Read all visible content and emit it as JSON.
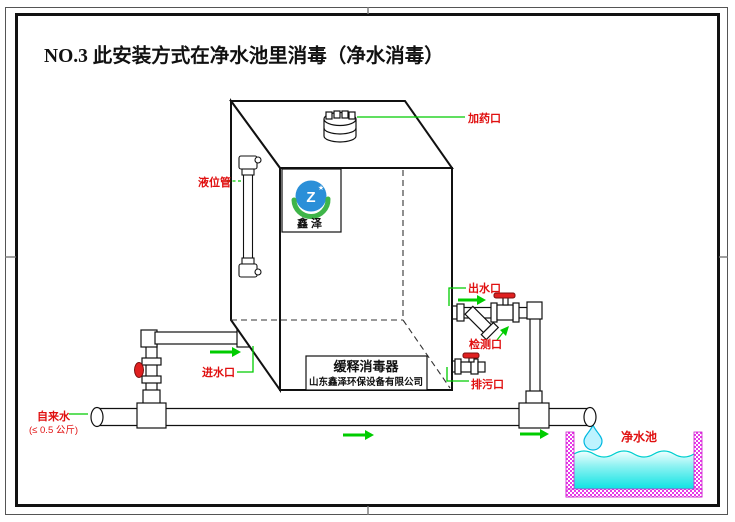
{
  "title": "NO.3  此安装方式在净水池里消毒（净水消毒）",
  "tank": {
    "logo_text": "鑫泽",
    "nameplate_line1": "缓释消毒器",
    "nameplate_line2": "山东鑫泽环保设备有限公司"
  },
  "port_labels": {
    "dosing": "加药口",
    "level_tube": "液位管",
    "inlet": "进水口",
    "outlet": "出水口",
    "test": "检测口",
    "drain": "排污口"
  },
  "annotations": {
    "tap_water": "自来水",
    "tap_water_pressure": "(≤ 0.5 公斤)",
    "pool": "净水池"
  },
  "colors": {
    "annotation_red": "#e01010",
    "leader_green": "#00cc00",
    "drawing_black": "#111111",
    "pool_wall_magenta": "#e83ae8",
    "water_cyan": "#0fe3e3",
    "logo_blue": "#2a8fd8",
    "logo_green": "#3fb549",
    "valve_red": "#e02020"
  }
}
